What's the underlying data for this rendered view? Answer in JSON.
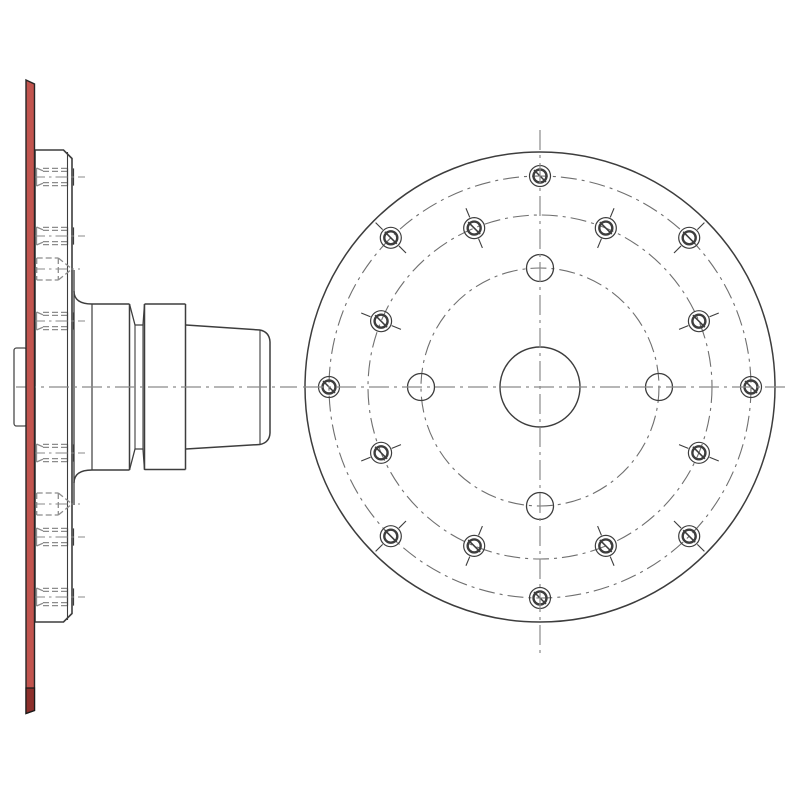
{
  "drawing": {
    "canvas": {
      "width": 800,
      "height": 800,
      "background": "#ffffff"
    },
    "palette": {
      "edge": "#3d3d3d",
      "hidden": "#8c8c8c",
      "centerline": "#8a8a8a",
      "boltcircle": "#6f6f6f",
      "highlight_fill": "#c1544e",
      "highlight_dark": "#8c2f2b",
      "highlight_edge": "#262626",
      "white": "#ffffff",
      "protrusion_edge": "#4a4a4a"
    },
    "side_view": {
      "axis": {
        "y": 387,
        "x1": 16,
        "x2": 297,
        "dash": "20 5 3 5"
      },
      "red_plate": {
        "x1": 26,
        "x2": 34.5,
        "y_top_left": 80,
        "y_top_right": 84,
        "y_bottom_left": 713.5,
        "y_bottom_right": 710.5,
        "dark_block_y1": 688
      },
      "protrusion": {
        "x": 14,
        "y": 348,
        "w": 13,
        "h": 78,
        "r": 2.5
      },
      "flange": {
        "x_left": 35,
        "x_right": 72,
        "y_top": 150,
        "y_bottom": 622,
        "chamfer": 8.5,
        "inner_edge_x": 67.5,
        "boss_face_x": 74,
        "boss_y1": 270,
        "boss_y2": 505,
        "fillet_top_y": 291,
        "fillet_bottom_y": 483
      },
      "hub": {
        "cyl1": {
          "x1": 92,
          "x2": 129.5,
          "y1": 304,
          "y2": 470
        },
        "groove": {
          "x1": 129.5,
          "x2": 144.5,
          "floor_x1": 135,
          "floor_x2": 143,
          "y_inner_top": 325,
          "y_inner_bottom": 449
        },
        "cyl2": {
          "x1": 144.5,
          "x2": 185.5,
          "y1": 304,
          "y2": 469.5
        },
        "taper": {
          "x1": 186,
          "x2": 260,
          "top_y1": 325,
          "top_y2": 330,
          "bot_y1": 449,
          "bot_y2": 444.5,
          "cap_x": 270,
          "cap_y1": 342,
          "cap_y2": 433
        }
      },
      "threaded_rows": {
        "y": [
          177,
          236,
          321,
          453,
          537,
          597
        ],
        "x_chamfer": 36.5,
        "x_dash_start": 43,
        "x_dash_end": 67.5,
        "x_end_bar": 73.5,
        "half_outer": 8.6,
        "half_inner": 5.6,
        "chamfer_half": 9,
        "chamfer_inner_half": 6.2,
        "axis_x1": 33,
        "axis_x2": 85,
        "dash": "6 3",
        "axis_dash": "12 4 2.5 4"
      },
      "cone_rows": {
        "y": [
          269,
          504
        ],
        "x1": 36.7,
        "x2": 58.3,
        "tip_x": 72,
        "half": 11,
        "axis_x1": 33,
        "axis_x2": 80,
        "dash": "6 3",
        "axis_dash": "12 4 2.5 4"
      }
    },
    "front_view": {
      "center": {
        "x": 540,
        "y": 387
      },
      "outer_radius": 235,
      "bore_radius": 40,
      "v_axis": {
        "y1": 130,
        "y2": 655
      },
      "h_axis": {
        "x1": 303,
        "x2": 790
      },
      "axis_dash": "20 5 3 5",
      "bolt_circle_dash": "16 5 3 5",
      "bolt_circles": [
        {
          "name": "outer-bolt-circle",
          "radius": 211,
          "count": 8,
          "start_deg": 0,
          "step_deg": 45,
          "style": "threaded",
          "ticks": "diagonals"
        },
        {
          "name": "middle-bolt-circle",
          "radius": 172,
          "count": 8,
          "start_deg": 22.5,
          "step_deg": 45,
          "style": "threaded",
          "ticks": "all"
        },
        {
          "name": "inner-bolt-circle",
          "radius": 119,
          "count": 4,
          "start_deg": 0,
          "step_deg": 90,
          "style": "plain",
          "ticks": "none"
        }
      ],
      "threaded_hole": {
        "outer_r": 10.5,
        "inner_r": 6.5,
        "slash_half": 6,
        "tick_r1": 11.5,
        "tick_r2": 21.5
      },
      "plain_hole_r": 13.5
    }
  }
}
